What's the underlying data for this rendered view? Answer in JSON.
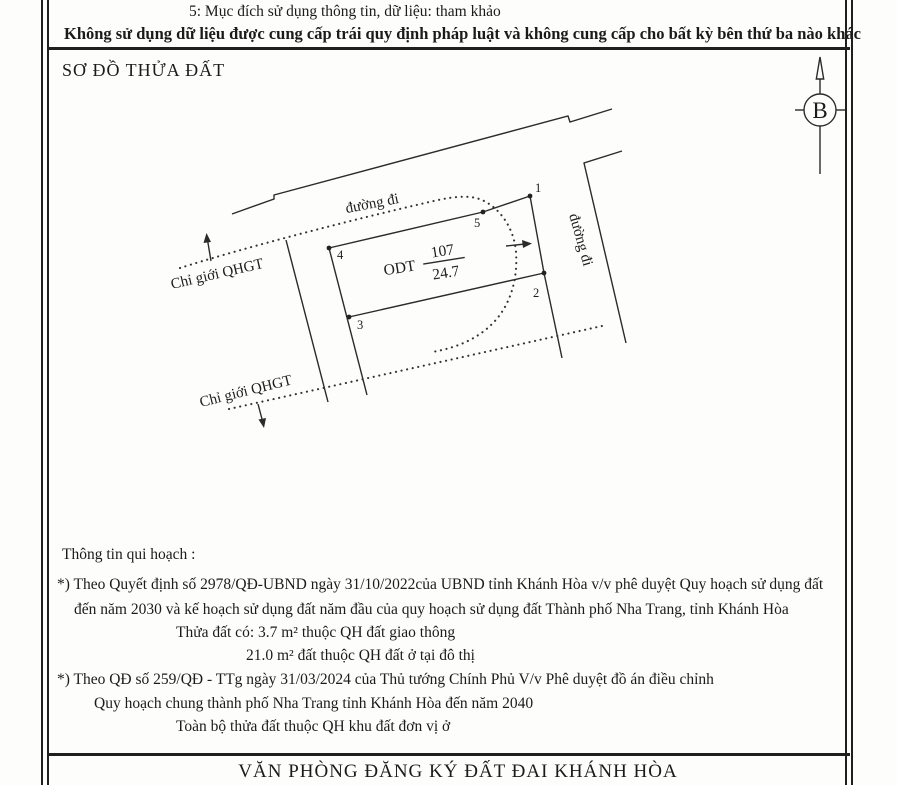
{
  "header": {
    "purpose_note": "5: Mục đích sử dụng thông tin, dữ liệu: tham khảo",
    "usage_warning": "Không sử dụng dữ liệu được cung cấp trái quy định pháp luật và không cung cấp cho bất kỳ bên thứ ba nào khác"
  },
  "diagram": {
    "title": "SƠ ĐỒ THỬA ĐẤT",
    "north_symbol": "B",
    "road_label_top": "đường đi",
    "road_label_right": "đường đi",
    "planning_boundary_label_upper": "Chỉ giới QHGT",
    "planning_boundary_label_lower": "Chỉ giới QHGT",
    "parcel": {
      "land_use_code": "ODT",
      "parcel_number": "107",
      "area": "24.7"
    },
    "points": [
      "1",
      "2",
      "3",
      "4",
      "5"
    ]
  },
  "planning": {
    "title": "Thông tin qui hoạch :",
    "lines": [
      "*) Theo Quyết định số 2978/QĐ-UBND ngày 31/10/2022của UBND tỉnh Khánh Hòa v/v phê duyệt Quy hoạch sử dụng đất",
      "đến năm 2030 và kế hoạch sử dụng đất năm đầu của quy hoạch sử dụng đất Thành phố Nha Trang, tỉnh Khánh Hòa",
      "Thửa đất có: 3.7 m² thuộc QH đất giao thông",
      "21.0 m² đất thuộc QH đất ở tại đô thị",
      "*) Theo QĐ số 259/QĐ - TTg ngày 31/03/2024 của Thủ tướng Chính Phủ V/v Phê duyệt đồ án điều chỉnh",
      "Quy hoạch chung thành phố Nha Trang tỉnh Khánh Hòa đến năm 2040",
      "Toàn bộ thửa đất thuộc QH khu đất đơn vị ở"
    ]
  },
  "footer": {
    "office": "VĂN PHÒNG ĐĂNG KÝ ĐẤT ĐAI KHÁNH HÒA"
  }
}
